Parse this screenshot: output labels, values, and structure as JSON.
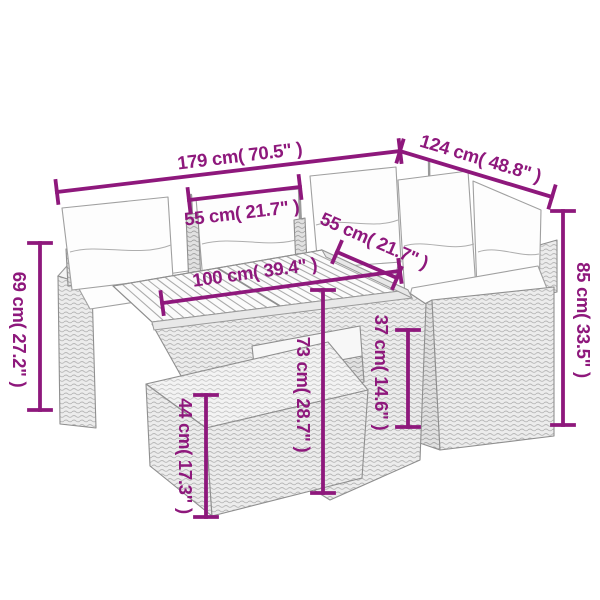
{
  "diagram": {
    "type": "furniture-dimension-diagram",
    "subject": "rattan garden lounge set with wood-slat table and ottoman",
    "background": "#ffffff"
  },
  "colors": {
    "dimension_accent": "#8e187c",
    "furniture_outline": "#9c9c9c"
  },
  "dimensions": {
    "overall_width": {
      "label": "179 cm( 70.5\" )"
    },
    "overall_depth": {
      "label": "124 cm( 48.8\" )"
    },
    "left_seat_width": {
      "label": "55 cm( 21.7\" )"
    },
    "right_seat_width": {
      "label": "55 cm( 21.7\" )"
    },
    "table_length": {
      "label": "100 cm( 39.4\" )"
    },
    "back_height": {
      "label": "85 cm( 33.5\" )"
    },
    "armrest_height": {
      "label": "69 cm( 27.2\" )"
    },
    "table_height": {
      "label": "73 cm( 28.7\" )"
    },
    "seat_height": {
      "label": "37 cm( 14.6\" )"
    },
    "ottoman_height": {
      "label": "44 cm( 17.3\" )"
    }
  }
}
